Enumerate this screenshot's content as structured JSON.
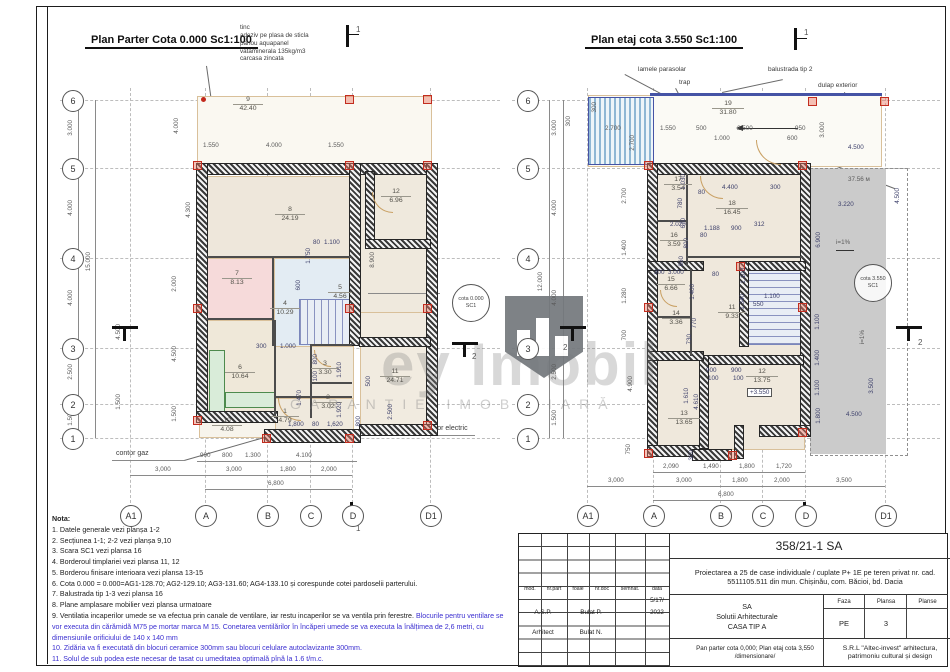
{
  "watermark": {
    "brand": "ey Imobil",
    "tagline": "GARANȚIE IMOBILIARĂ"
  },
  "pp": {
    "title": "Plan Parter Cota 0.000  Sc1:100",
    "callout": [
      "tinc",
      "adeziv pe plasa de sticla",
      "panou aquapanel",
      "vataminerala 135kg/m3",
      "carcasa zincata"
    ],
    "sec_top": "1",
    "sec_bottom": "1",
    "sec_side": "2",
    "grid_rows": [
      "6",
      "5",
      "4",
      "3",
      "2",
      "1"
    ],
    "grid_cols": [
      "A1",
      "A",
      "B",
      "C",
      "D",
      "D1"
    ],
    "row_out": [
      "3.000",
      "4.000",
      "4.000",
      "2.500",
      "1.500"
    ],
    "row_total": "15.000",
    "row_in": [
      "4.000",
      "4.300",
      "2.000",
      "4.500",
      "1.500"
    ],
    "top": [
      "1.550",
      "4.000",
      "1.550"
    ],
    "bot1": [
      "900",
      "800",
      "1.300",
      "4.100"
    ],
    "bot2": [
      "3,000",
      "3,000",
      "1,800",
      "2,000"
    ],
    "bot_total": "6,800",
    "rooms": {
      "r9": {
        "n": "9",
        "a": "42.40"
      },
      "r8": {
        "n": "8",
        "a": "24.19"
      },
      "r12": {
        "n": "12",
        "a": "6.96"
      },
      "r7": {
        "n": "7",
        "a": "8.13"
      },
      "r4": {
        "n": "4",
        "a": "10.29"
      },
      "r5": {
        "n": "5",
        "a": "4.56"
      },
      "r6": {
        "n": "6",
        "a": "10.64"
      },
      "r3": {
        "n": "3",
        "a": "3.30"
      },
      "r2": {
        "n": "2",
        "a": "3.02"
      },
      "r1": {
        "n": "1",
        "a": "4.79"
      },
      "r10": {
        "n": "10",
        "a": "4.08"
      },
      "r11": {
        "n": "11",
        "a": "24.71"
      }
    },
    "m": [
      "80",
      "1.100",
      "1.750",
      "600",
      "8.900",
      "300",
      "1.000",
      "800",
      "100",
      "1.910",
      "1.470",
      "1.920",
      "500",
      "2.500",
      "1,800",
      "80",
      "1,620",
      "800",
      "4.500",
      "1.500"
    ],
    "balustrada": "balustrada tip 3",
    "cota": [
      "cota 0.000",
      "SC1"
    ],
    "contor_gaz": "contor gaz",
    "contor_electric": "contor electric"
  },
  "pe": {
    "title": "Plan etaj cota 3.550    Sc1:100",
    "callouts": [
      "lamele parasolar",
      "trap",
      "balustrada tip 2",
      "dulap exterior"
    ],
    "sec_top": "1",
    "sec_side": "2",
    "grid_rows": [
      "6",
      "5",
      "4",
      "3",
      "2",
      "1"
    ],
    "grid_cols": [
      "A1",
      "A",
      "B",
      "C",
      "D",
      "D1"
    ],
    "row_out": [
      "3.000",
      "4.000",
      "4.000",
      "2.500",
      "1.500"
    ],
    "row_total": "12.000",
    "row_in": [
      "2.700",
      "1.400",
      "1.280",
      "700",
      "4.900",
      "750"
    ],
    "top": [
      "300",
      "2.700",
      "2.700",
      "1.550",
      "500",
      "1.000",
      "2.500",
      "950",
      "600",
      "3.000",
      "300"
    ],
    "bot1": [
      "2,090",
      "1,490",
      "1,800",
      "1,720"
    ],
    "bot2": [
      "3,000",
      "3,000",
      "1,800",
      "2,000",
      "3,500"
    ],
    "bot_total": "6,800",
    "rooms": {
      "r19": {
        "n": "19",
        "a": "31.80"
      },
      "r17": {
        "n": "17",
        "a": "3.54"
      },
      "r18": {
        "n": "18",
        "a": "16.45"
      },
      "r16": {
        "n": "16",
        "a": "3.59"
      },
      "r15": {
        "n": "15",
        "a": "6.66"
      },
      "r14": {
        "n": "14",
        "a": "3.36"
      },
      "r11": {
        "n": "11",
        "a": "9.33"
      },
      "r12": {
        "n": "12",
        "a": "13.75"
      },
      "r13": {
        "n": "13",
        "a": "13.65"
      }
    },
    "plus": "+3.550",
    "m": [
      "4.400",
      "300",
      "1.030",
      "780",
      "80",
      "670",
      "800",
      "2.020",
      "1.188",
      "900",
      "312",
      "80",
      "300",
      "3.000",
      "80",
      "860",
      "1.400",
      "770",
      "730",
      "1.100",
      "1.340",
      "550",
      "1.100",
      "900",
      "100",
      "900",
      "100",
      "1.610",
      "4.610",
      "300"
    ],
    "right": [
      "37.56 м",
      "3.220",
      "6.900",
      "i=1%",
      "1.100",
      "1.400",
      "1.100",
      "1.800",
      "3.500",
      "4.500",
      "i=1%",
      "4.500",
      "4.500"
    ],
    "cota": [
      "cota 3.550",
      "SC1"
    ]
  },
  "notes": {
    "heading": "Nota:",
    "n1": "1. Datele generale vezi planșa 1-2",
    "n2": "2. Secțiunea 1-1; 2-2 vezi planșa 9,10",
    "n3": "3. Scara SC1 vezi plansa 16",
    "n4": "4. Borderoul timplariei vezi plansa 11, 12",
    "n5": "5. Borderou finisare interioara vezi plansa 13-15",
    "n6": "6. Cota 0.000 = 0.000=AG1-128.70; AG2-129.10; AG3-131.60; AG4-133.10 și corespunde cotei pardoselii parterului.",
    "n7": "7. Balustrada tip 1-3 vezi plansa 16",
    "n8": "8. Plane amplasare mobilier vezi plansa urmatoare",
    "n9a": "9. Ventilatia incaperilor umede se va efectua prin canale de ventilare, iar restu incaperilor se va ventila prin ferestre.",
    "n9b": "Blocurile pentru ventilare se vor executa din cărămidă M75 pe mortar marca M 15. Conetarea ventilărilor în încăperi umede se va executa la înălțimea de 2,6 metri, cu dimensiunile orificiului de 140 x 140 mm",
    "n10": "10. Zidăria va fi executată din blocuri ceramice 300mm sau blocuri celulare autoclavizante 300mm.",
    "n11": "11. Solul de sub podea este necesar de tasat cu umeditatea optimală pînă la 1.6 t/m.c."
  },
  "tb": {
    "code": "358/21-1 SA",
    "project": "Proiectarea a 25 de case individuale / cuplate P+ 1E pe teren privat nr. cad. 5511105.511 din mun. Chișinău, com. Băcioi, bd. Dacia",
    "h_mod": "mod.",
    "h_nrpart": "nr.part",
    "h_foaie": "foaie",
    "h_nrdoc": "nr.doc",
    "h_semnat": "semnat.",
    "h_data": "data",
    "date1": "5/17/",
    "date2": "2022",
    "row1_role": "A.S.P.",
    "row1_name": "Bulat P.",
    "row2_role": "Arhitect",
    "row2_name": "Bulat N.",
    "org1": "SA",
    "org2": "Solutii Arhitecturale",
    "org3": "CASA TIP A",
    "faza_h": "Faza",
    "plansa_h": "Plansa",
    "planse_h": "Planse",
    "faza": "PE",
    "plansa": "3",
    "desc": "Pan parter cota 0,000; Plan etaj cota 3,550 /dimensionare/",
    "firm": "S.R.L \"Altec-invest\" arhitectura, patrimoniu cultural și design"
  }
}
